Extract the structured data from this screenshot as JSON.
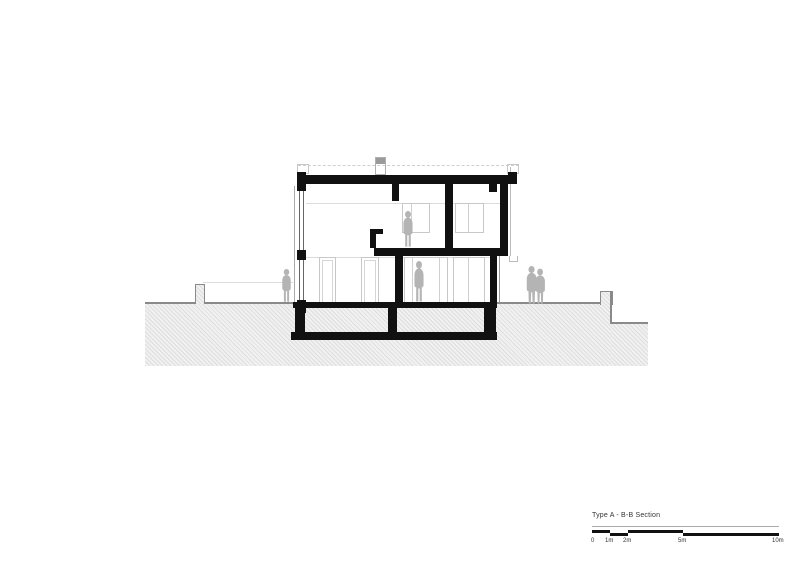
{
  "drawing": {
    "title": "Type A - B-B Section",
    "scale_bar": {
      "labels": [
        "0",
        "1m",
        "2m",
        "5m",
        "10m"
      ]
    },
    "colors": {
      "ink": "#111111",
      "ground_line": "#8a8a8a",
      "hatch_bg": "#f1f1f1",
      "hatch_line": "#dedede",
      "light_outline": "#c8c8c8",
      "figure_gray": "#b4b4b4"
    },
    "figures": [
      "person-outside-left",
      "person-upper-level",
      "person-ground-floor",
      "couple-outside-right"
    ]
  }
}
